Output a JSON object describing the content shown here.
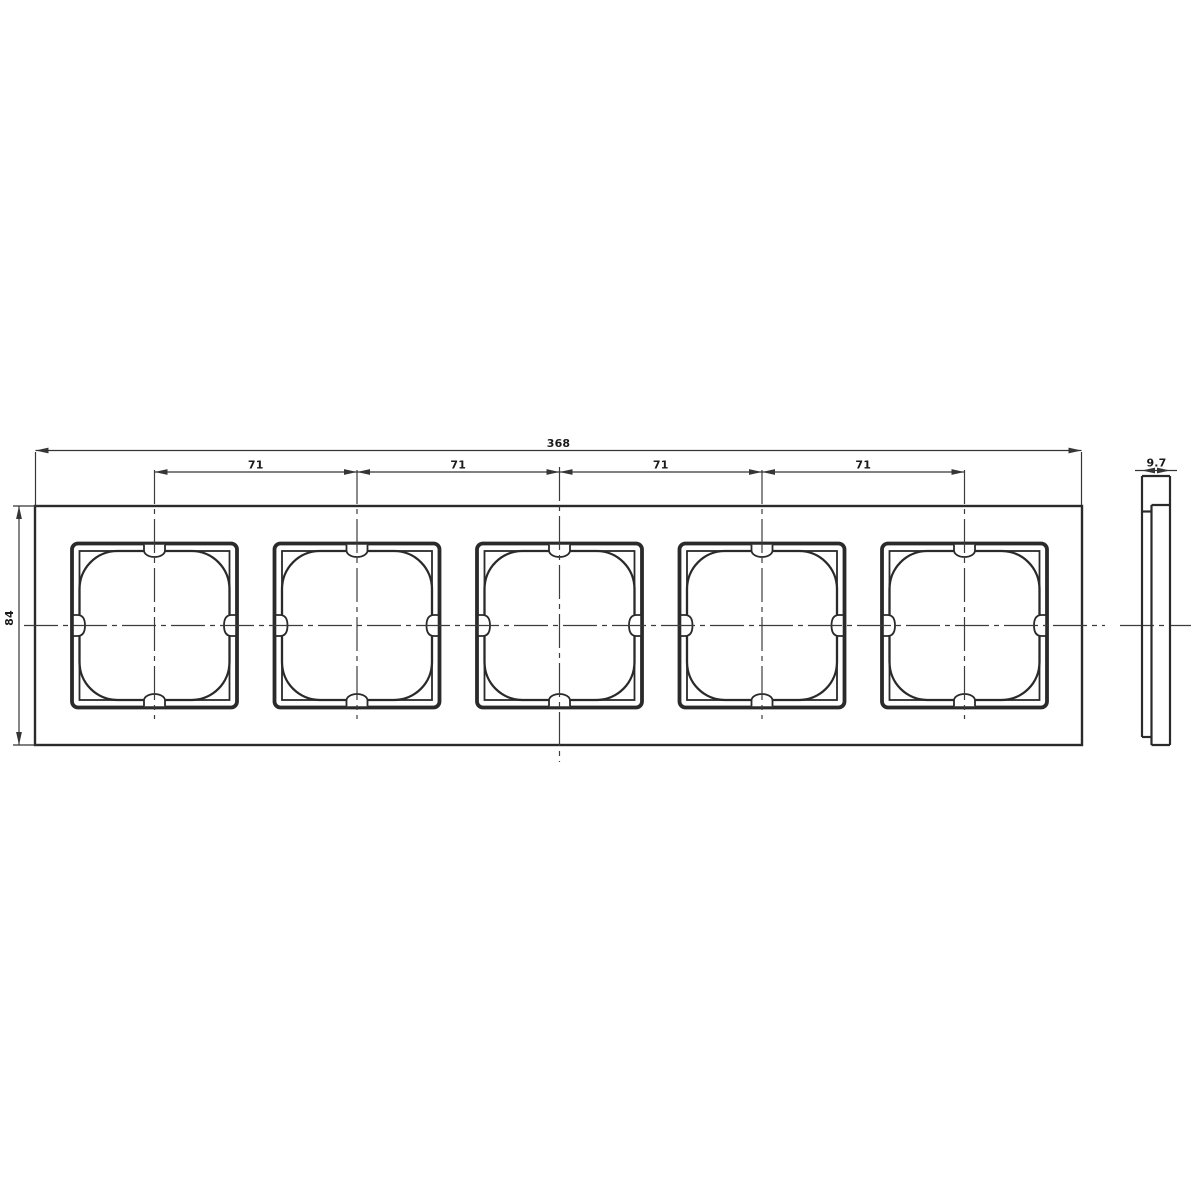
{
  "drawing": {
    "description": "Technical drawing of a 5-gang cover frame: front view with five square windows and side profile view",
    "gang_count": 5,
    "dimensions": {
      "overall_width_mm": "368",
      "module_spacing_mm": [
        "71",
        "71",
        "71",
        "71"
      ],
      "height_mm": "84",
      "depth_mm": "9.7"
    },
    "colors": {
      "line": "#2a2a2a",
      "dim_line": "#353535",
      "centerline": "#3c3c3c",
      "background": "#ffffff"
    }
  }
}
